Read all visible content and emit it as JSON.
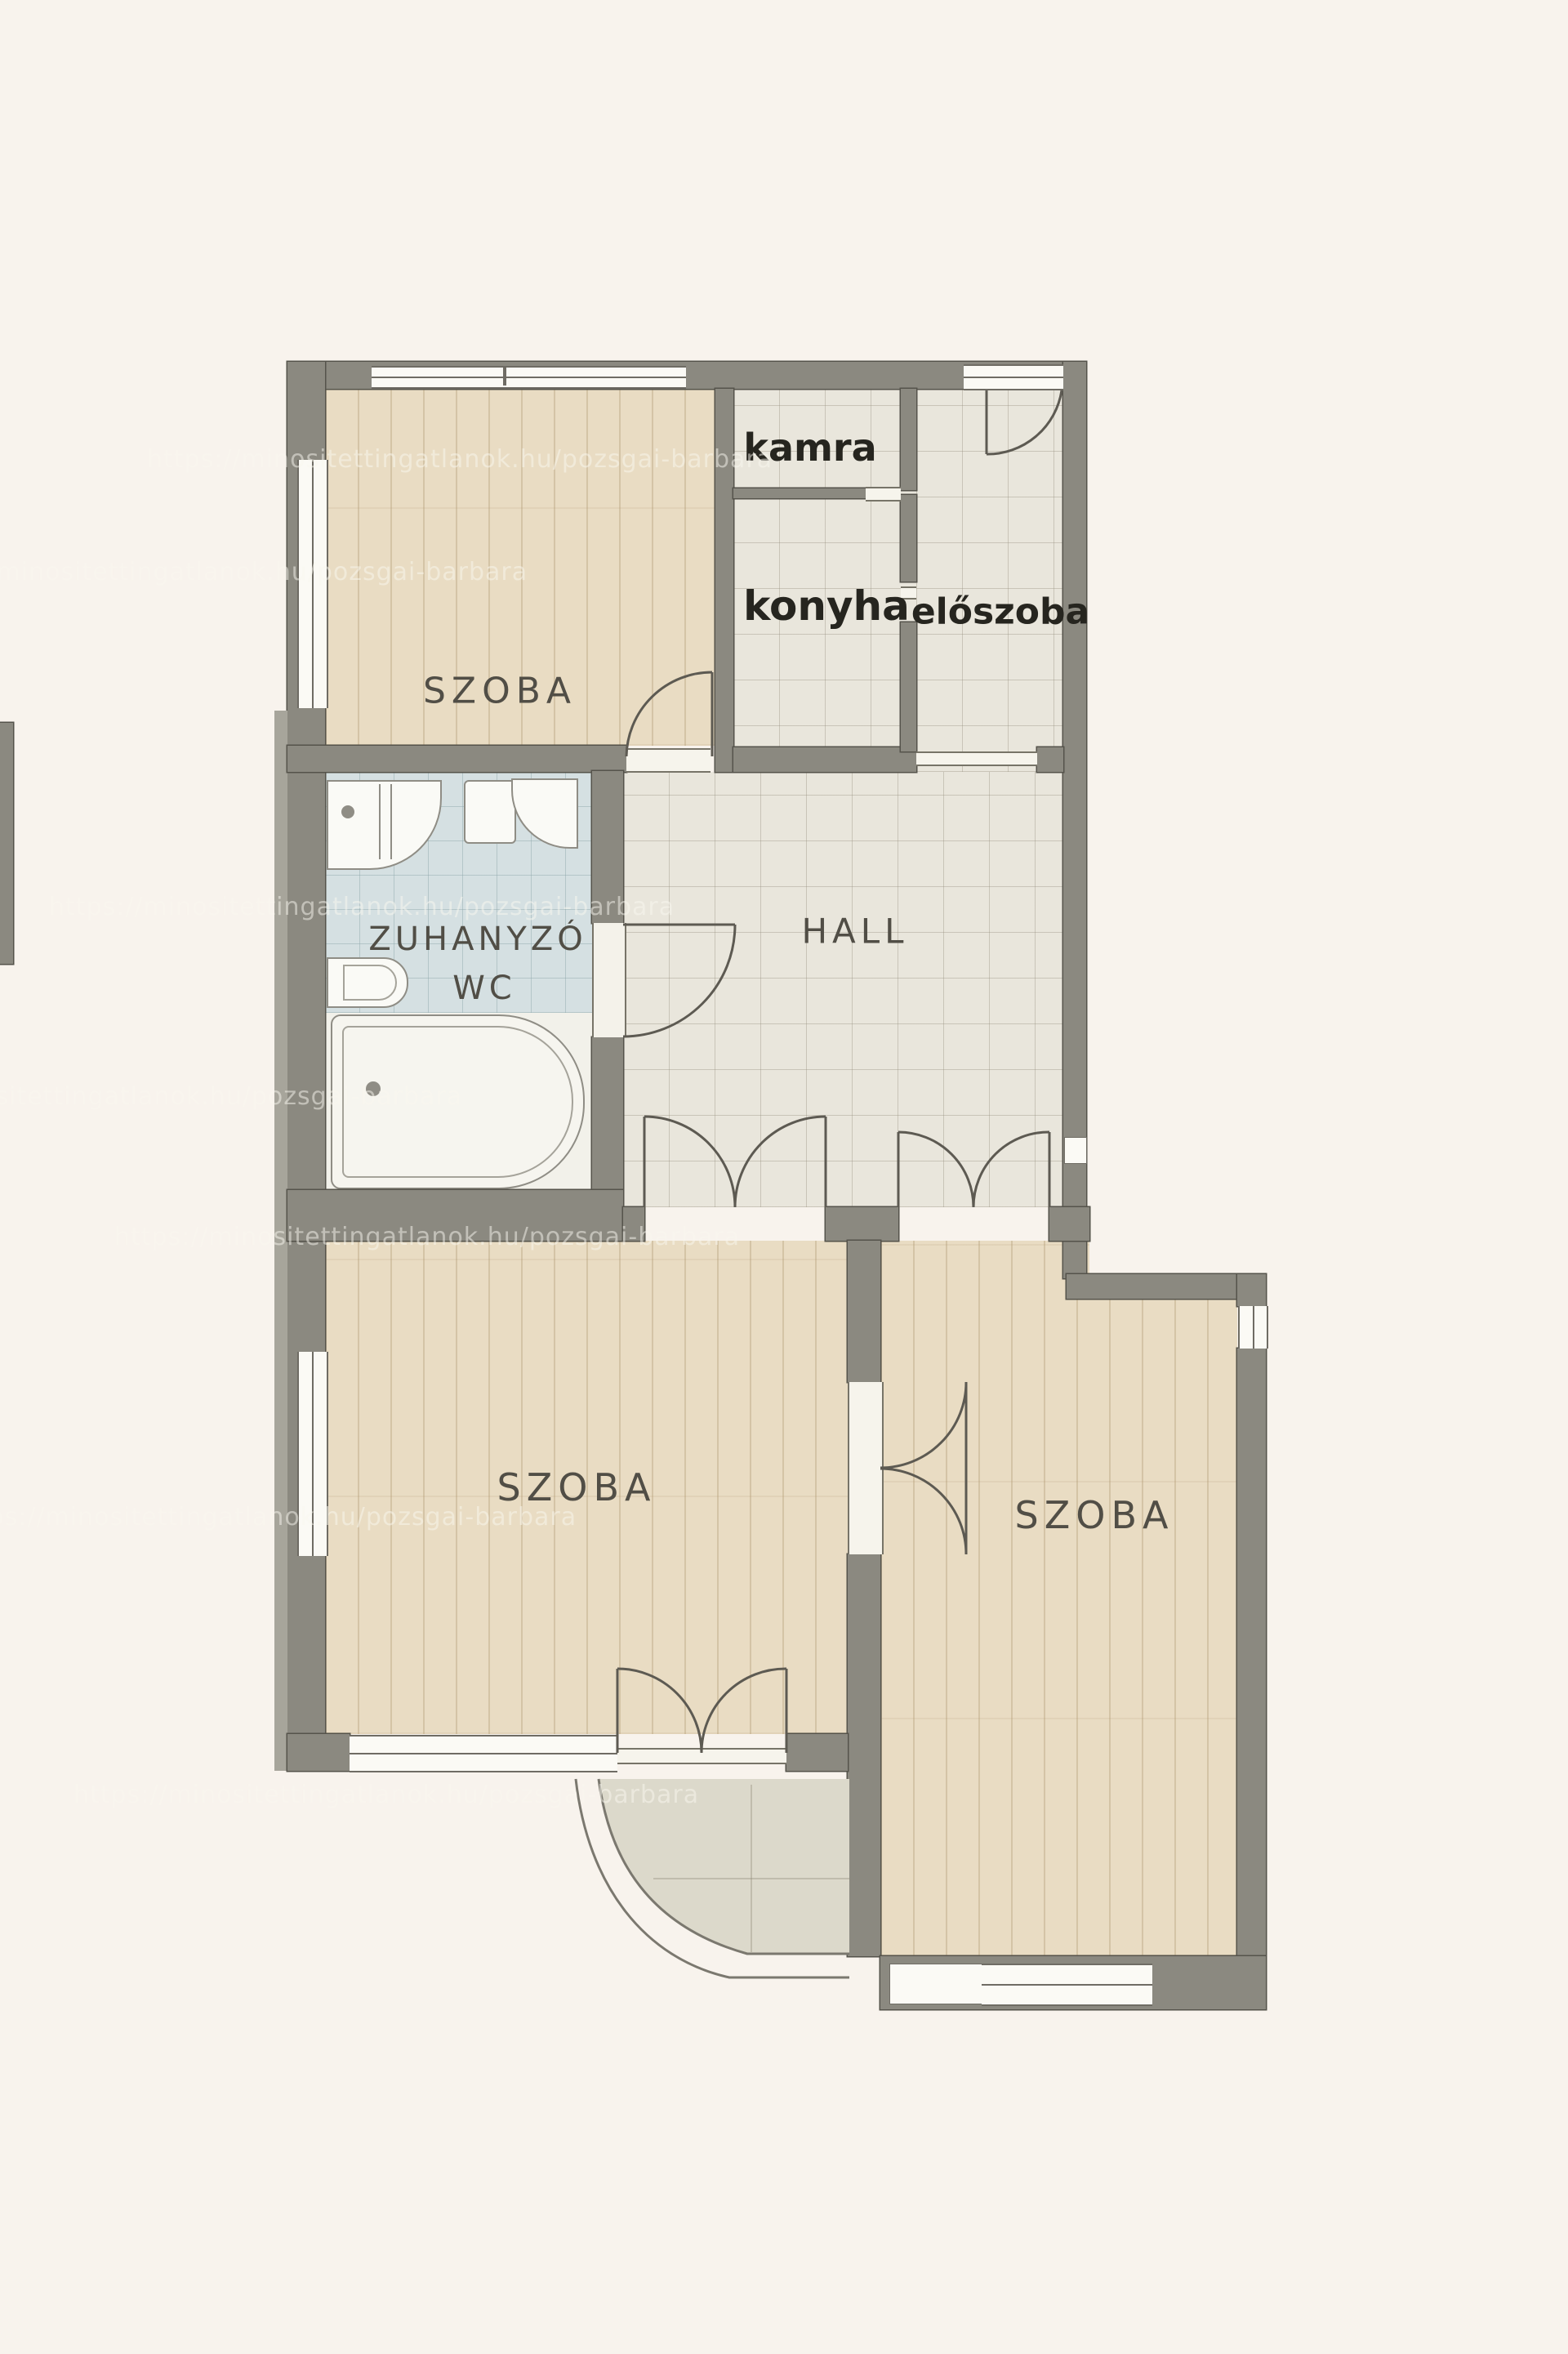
{
  "rooms": {
    "szoba_top": "SZOBA",
    "kamra": "kamra",
    "konyha": "konyha",
    "eloszoba": "előszoba",
    "zuhanyzo_line1": "ZUHANYZÓ",
    "zuhanyzo_line2": "WC",
    "hall": "HALL",
    "szoba_left": "SZOBA",
    "szoba_right": "SZOBA"
  },
  "watermark": {
    "text": "https://minositettingatlanok.hu/pozsgai-barbara"
  },
  "colors": {
    "background": "#f8f3ed",
    "wall": "#8b8980",
    "wood_floor": "#e9dcc3",
    "tile_floor": "#e9e6dc",
    "bathroom_tile": "#d5e0e2",
    "balcony_tile": "#dcd9cb",
    "label_dark": "#26251f",
    "label_muted": "#514e46"
  }
}
